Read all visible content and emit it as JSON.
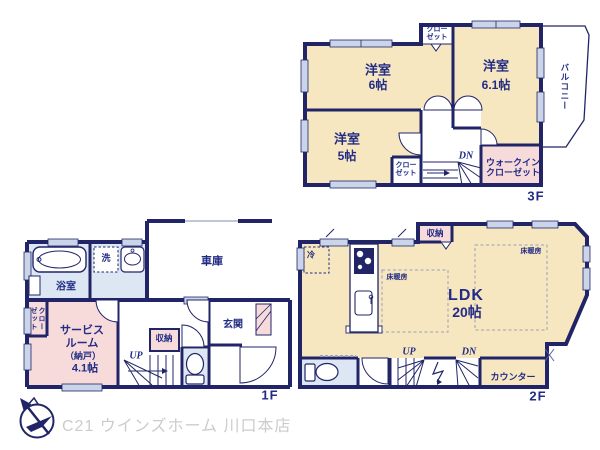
{
  "colors": {
    "wall": "#212568",
    "text": "#232C85",
    "room_cream": "#F6E7C0",
    "closet_pink": "#F7DBDB",
    "wet_blue": "#DCE7F3",
    "window_fill": "#CBD5E9",
    "footer_gray": "#CCCCCC"
  },
  "footer": {
    "brand": "C21 ウインズホーム 川口本店"
  },
  "floor3": {
    "label": "3F",
    "bedroom_west": {
      "name": "洋室",
      "size": "6帖"
    },
    "bedroom_east": {
      "name": "洋室",
      "size": "6.1帖"
    },
    "bedroom_south": {
      "name": "洋室",
      "size": "5帖"
    },
    "closet_north": "クロー\nゼット",
    "closet_south": "クロー\nゼット",
    "walk_in_closet": "ウォークイン\nクローゼット",
    "balcony": "バルコニー",
    "stairs_down": "DN"
  },
  "floor2": {
    "label": "2F",
    "ldk": {
      "name": "LDK",
      "size": "20帖"
    },
    "storage": "収納",
    "refrigerator": "冷",
    "floor_heating_left": "床暖房",
    "floor_heating_right": "床暖房",
    "counter": "カウンター",
    "stairs_up": "UP",
    "stairs_down": "DN"
  },
  "floor1": {
    "label": "1F",
    "garage": "車庫",
    "bathroom": "浴室",
    "laundry": "洗",
    "closet": "クロー\nゼット",
    "service_room": {
      "name": "サービス\nルーム",
      "note": "（納戸）",
      "size": "4.1帖"
    },
    "storage": "収納",
    "entrance": "玄関",
    "stairs_up": "UP"
  }
}
